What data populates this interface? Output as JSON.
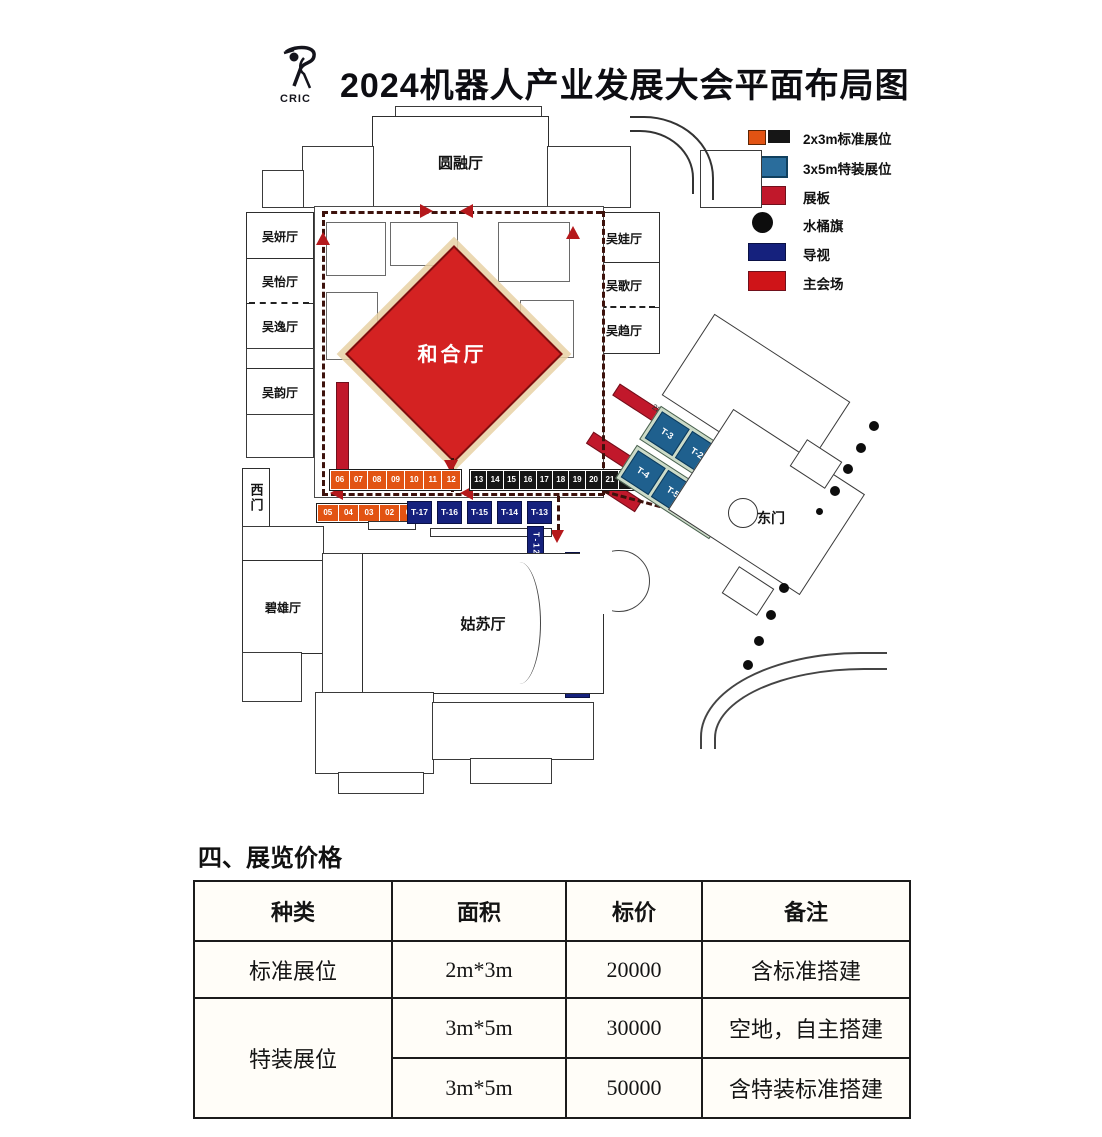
{
  "header": {
    "logo": "CRIC",
    "title": "2024机器人产业发展大会平面布局图"
  },
  "legend": {
    "items": [
      {
        "label": "2x3m标准展位",
        "colors": [
          "#e25313",
          "#161616"
        ],
        "shape": "double-rect"
      },
      {
        "label": "3x5m特装展位",
        "colors": [
          "#2a6d9c"
        ],
        "shape": "rect"
      },
      {
        "label": "展板",
        "colors": [
          "#c1182b"
        ],
        "shape": "rect"
      },
      {
        "label": "水桶旗",
        "colors": [
          "#0d0d0d"
        ],
        "shape": "circle"
      },
      {
        "label": "导视",
        "colors": [
          "#15217d"
        ],
        "shape": "rect"
      },
      {
        "label": "主会场",
        "colors": [
          "#cf1418"
        ],
        "shape": "rect"
      }
    ]
  },
  "floorplan": {
    "rooms": {
      "yuanrong": "圆融厅",
      "wuyan": "吴妍厅",
      "wuyi": "吴怡厅",
      "wuyiB": "吴逸厅",
      "wuyun": "吴韵厅",
      "wuwa": "吴娃厅",
      "wuge": "吴歌厅",
      "wuqu": "吴趋厅",
      "hehe": "和合厅",
      "gusu": "姑苏厅",
      "bixiong": "碧雄厅",
      "west_gate": "西门",
      "east_gate": "东门"
    },
    "booths": {
      "std_row_a": [
        "06",
        "07",
        "08",
        "09",
        "10",
        "11",
        "12"
      ],
      "std_row_b": [
        "13",
        "14",
        "15",
        "16",
        "17",
        "18",
        "19",
        "20",
        "21",
        "22"
      ],
      "std_row_c": [
        "05",
        "04",
        "03",
        "02",
        "01"
      ],
      "sign_row": [
        "T-17",
        "T-16",
        "T-15",
        "T-14",
        "T-13"
      ],
      "sign_v": [
        "T-12",
        "T-11",
        "T-10",
        "T-9",
        "T-8",
        "T-7"
      ],
      "special_row_1": [
        "T-3",
        "T-2",
        "T-1"
      ],
      "special_row_2": [
        "T-4",
        "T-5",
        "T-6"
      ]
    },
    "dimension_note": "22m"
  },
  "pricing": {
    "section_title": "四、展览价格",
    "table": {
      "headers": [
        "种类",
        "面积",
        "标价",
        "备注"
      ],
      "rows": [
        {
          "type": "标准展位",
          "area": "2m*3m",
          "price": "20000",
          "note": "含标准搭建"
        },
        {
          "type": "特装展位",
          "area": "3m*5m",
          "price": "30000",
          "note": "空地，自主搭建"
        },
        {
          "type": "",
          "area": "3m*5m",
          "price": "50000",
          "note": "含特装标准搭建"
        }
      ]
    }
  }
}
